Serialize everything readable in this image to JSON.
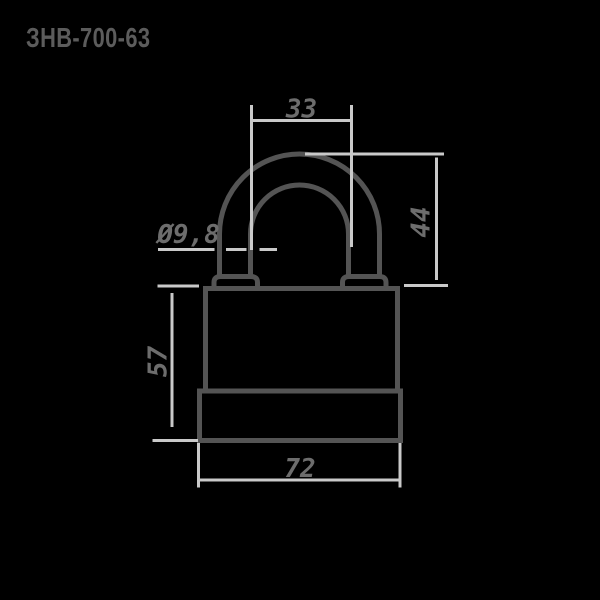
{
  "title": "ЗНВ-700-63",
  "drawing": {
    "kind": "padlock-dimension-drawing",
    "dimensions": {
      "shackle_inner_width": "33",
      "shackle_diameter": "Ø9,8",
      "shackle_height": "44",
      "body_height": "57",
      "body_width": "72"
    }
  },
  "colors": {
    "background": "#000000",
    "outline": "#545454",
    "dimension_line": "#c9c9c9",
    "dimension_text": "#6d6d6d",
    "title_text": "#5c5c5c"
  }
}
